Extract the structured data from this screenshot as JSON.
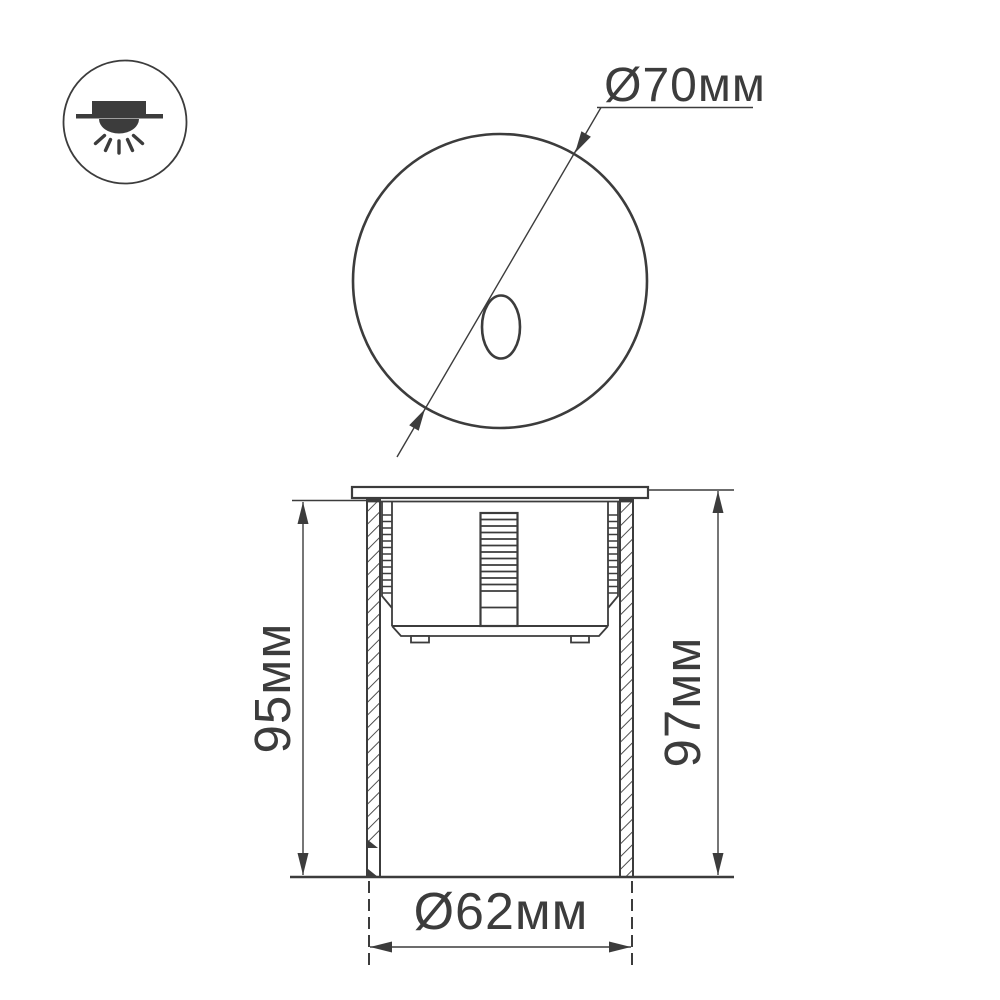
{
  "drawing": {
    "type": "luminaire-dimension-drawing",
    "background_color": "#ffffff",
    "line_color": "#3c3c3c",
    "legend_icon": "recessed-downlight-icon",
    "front_view": {
      "shape": "circle-with-oval-aperture",
      "diameter_label": "Ø70мм"
    },
    "side_view": {
      "height_left_label": "95мм",
      "height_right_label": "97мм",
      "body_diameter_label": "Ø62мм"
    }
  }
}
